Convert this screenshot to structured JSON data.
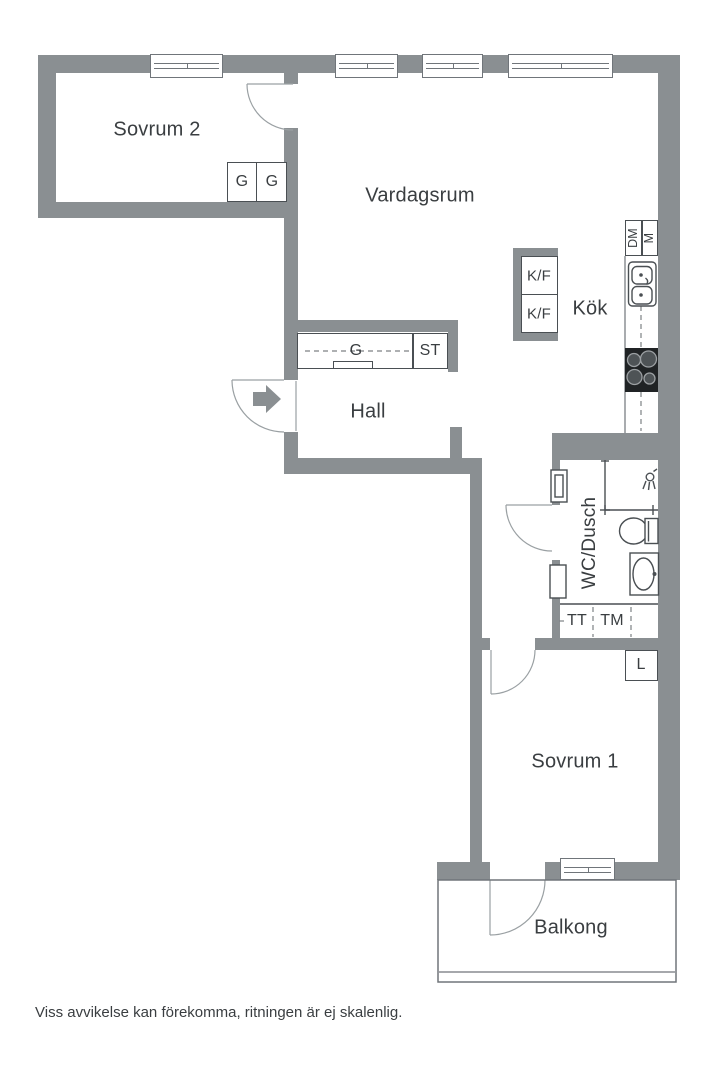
{
  "floorplan": {
    "disclaimer": "Viss avvikelse kan förekomma, ritningen är ej skalenlig.",
    "rooms": {
      "bedroom2": "Sovrum 2",
      "living_room": "Vardagsrum",
      "kitchen": "Kök",
      "hall": "Hall",
      "bathroom": "WC/Dusch",
      "bedroom1": "Sovrum 1",
      "balcony": "Balkong"
    },
    "units": {
      "wardrobe_a": "G",
      "wardrobe_b": "G",
      "hall_wardrobe": "G",
      "cleaning_cabinet": "ST",
      "fridge_freezer_top": "K/F",
      "fridge_freezer_bottom": "K/F",
      "dishwasher": "DM",
      "microwave": "M",
      "dryer": "TT",
      "washing_machine": "TM",
      "linen_cabinet": "L"
    },
    "colors": {
      "wall": "#8a8f92",
      "outline": "#4a4f53",
      "window_frame": "#70757a",
      "arc": "#9aa0a3",
      "dashed": "#7d8184",
      "text": "#3a3e41",
      "stove": "#202325",
      "background": "#ffffff"
    }
  }
}
